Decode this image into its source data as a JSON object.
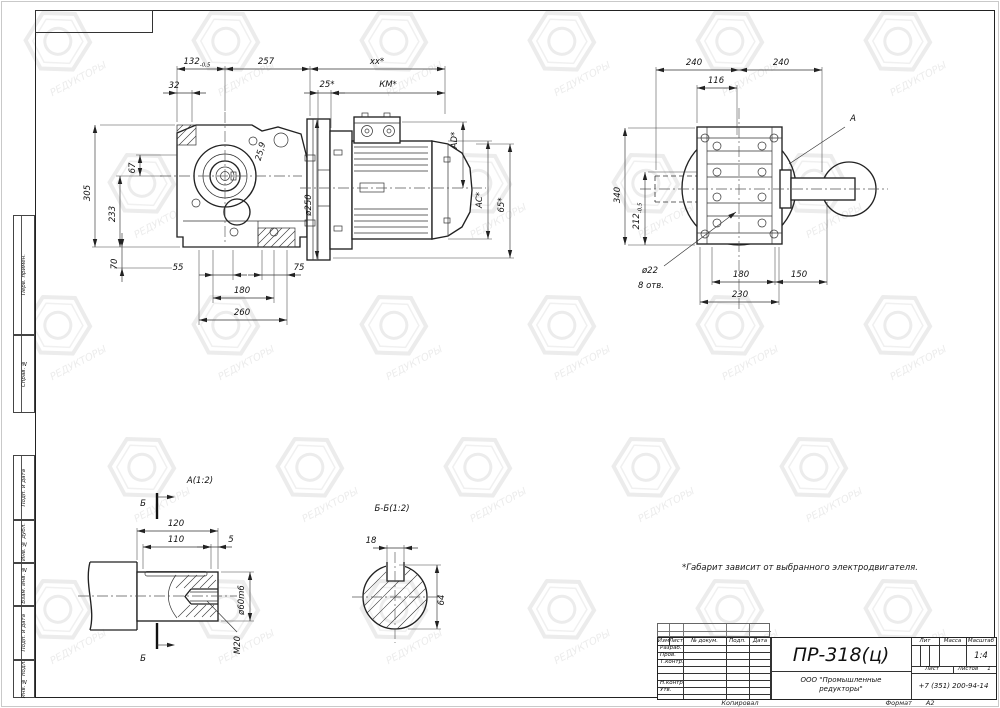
{
  "watermark": {
    "text": "РЕДУКТОРЫ"
  },
  "note": "*Габарит зависит от выбранного электродвигателя.",
  "margin_labels": [
    "Перв. примен.",
    "Справ. №",
    "Подп. и дата",
    "Инв. № дубл.",
    "Взам. инв. №",
    "Подп. и дата",
    "Инв. № подл."
  ],
  "title_block": {
    "doc_number": "ПР-318(ц)",
    "col_headers": [
      "Изм",
      "Лист",
      "№ докум.",
      "Подп.",
      "Дата"
    ],
    "row_labels": [
      "Разраб.",
      "Пров.",
      "Т.контр.",
      "Н.контр.",
      "Утв."
    ],
    "lit_label": "Лит",
    "mass_label": "Масса",
    "scale_label": "Масштаб",
    "scale_value": "1:4",
    "sheet_label": "Лист",
    "sheets_label": "Листов",
    "sheets_value": "1",
    "company_line1": "ООО \"Промышленные",
    "company_line2": "редукторы\"",
    "phone": "+7 (351) 200-94-14",
    "copied_label": "Копировал",
    "format_label": "Формат",
    "format_value": "А2"
  },
  "drawing": {
    "front": [
      {
        "t": "h",
        "x1": 177,
        "x2": 225,
        "y": 69,
        "tx": 197,
        "ty": 64,
        "s": "132",
        "sub": "-0,5",
        "ext": [
          [
            177,
            122,
            177,
            66
          ],
          [
            225,
            111,
            225,
            66
          ]
        ]
      },
      {
        "t": "h",
        "x1": 225,
        "x2": 310,
        "y": 69,
        "tx": 266,
        "ty": 64,
        "s": "257",
        "ext": [
          [
            310,
            116,
            310,
            66
          ]
        ]
      },
      {
        "t": "h",
        "x1": 310,
        "x2": 445,
        "y": 69,
        "tx": 377,
        "ty": 64,
        "s": "xx*",
        "ext": [
          [
            445,
            114,
            445,
            66
          ]
        ]
      },
      {
        "t": "h",
        "x1": 177,
        "x2": 192,
        "y": 93,
        "tx": 174,
        "ty": 88,
        "s": "32",
        "out": 1,
        "ext": [
          [
            192,
            122,
            192,
            90
          ]
        ]
      },
      {
        "t": "h",
        "x1": 318,
        "x2": 331,
        "y": 93,
        "tx": 327,
        "ty": 87,
        "s": "25*",
        "out": 1,
        "ext": [
          [
            318,
            128,
            318,
            90
          ],
          [
            331,
            128,
            331,
            90
          ]
        ]
      },
      {
        "t": "h",
        "x1": 331,
        "x2": 445,
        "y": 93,
        "tx": 388,
        "ty": 87,
        "s": "КМ*"
      },
      {
        "t": "h",
        "x1": 213,
        "x2": 233,
        "y": 275,
        "tx": 178,
        "ty": 270,
        "s": "55",
        "out": 1,
        "ext": [
          [
            213,
            250,
            213,
            303
          ],
          [
            233,
            250,
            233,
            280
          ]
        ]
      },
      {
        "t": "h",
        "x1": 262,
        "x2": 287,
        "y": 275,
        "tx": 299,
        "ty": 270,
        "s": "75",
        "out": 1,
        "ext": [
          [
            262,
            250,
            262,
            280
          ],
          [
            287,
            250,
            287,
            325
          ]
        ]
      },
      {
        "t": "h",
        "x1": 213,
        "x2": 274,
        "y": 298,
        "tx": 242,
        "ty": 293,
        "s": "180",
        "ext": [
          [
            274,
            250,
            274,
            303
          ]
        ]
      },
      {
        "t": "h",
        "x1": 199,
        "x2": 287,
        "y": 320,
        "tx": 242,
        "ty": 315,
        "s": "260",
        "ext": [
          [
            199,
            250,
            199,
            325
          ]
        ]
      },
      {
        "t": "v",
        "x": 95,
        "y1": 125,
        "y2": 247,
        "tx": 90,
        "ty": 193,
        "s": "305",
        "ext": [
          [
            100,
            125,
            175,
            125
          ],
          [
            92,
            247,
            180,
            247
          ]
        ]
      },
      {
        "t": "v",
        "x": 120,
        "y1": 176,
        "y2": 247,
        "tx": 115,
        "ty": 214,
        "s": "233",
        "ext": [
          [
            116,
            176,
            162,
            176
          ]
        ]
      },
      {
        "t": "v",
        "x": 140,
        "y1": 155,
        "y2": 176,
        "tx": 135,
        "ty": 168,
        "s": "67",
        "ext": [
          [
            136,
            155,
            177,
            155
          ]
        ]
      },
      {
        "t": "v",
        "x": 122,
        "y1": 247,
        "y2": 268,
        "tx": 117,
        "ty": 264,
        "s": "70",
        "out": 1,
        "ext": [
          [
            114,
            268,
            172,
            268
          ]
        ]
      },
      {
        "t": "v",
        "x": 463,
        "y1": 122,
        "y2": 188,
        "tx": 457,
        "ty": 140,
        "s": "AD*",
        "ext": [
          [
            402,
            122,
            467,
            122
          ]
        ]
      },
      {
        "t": "v",
        "x": 488,
        "y1": 141,
        "y2": 239,
        "tx": 482,
        "ty": 200,
        "s": "AC*",
        "ext": [
          [
            448,
            141,
            492,
            141
          ],
          [
            448,
            239,
            492,
            239
          ]
        ]
      },
      {
        "t": "v",
        "x": 510,
        "y1": 144,
        "y2": 258,
        "tx": 504,
        "ty": 205,
        "s": "65*",
        "ext": [
          [
            476,
            144,
            514,
            144
          ],
          [
            333,
            258,
            514,
            258
          ]
        ]
      },
      {
        "t": "v",
        "x": 317,
        "y1": 120,
        "y2": 259,
        "tx": 311,
        "ty": 205,
        "s": "ø250"
      },
      {
        "t": "t",
        "tx": 263,
        "ty": 152,
        "s": "25,9",
        "rot": -75
      }
    ],
    "side": [
      {
        "t": "h",
        "x1": 656,
        "x2": 739,
        "y": 70,
        "tx": 694,
        "ty": 65,
        "s": "240",
        "ext": [
          [
            656,
            170,
            656,
            67
          ]
        ]
      },
      {
        "t": "h",
        "x1": 739,
        "x2": 822,
        "y": 70,
        "tx": 781,
        "ty": 65,
        "s": "240",
        "ext": [
          [
            822,
            172,
            822,
            67
          ]
        ]
      },
      {
        "t": "h",
        "x1": 697,
        "x2": 737,
        "y": 88,
        "tx": 716,
        "ty": 83,
        "s": "116",
        "ext": [
          [
            697,
            123,
            697,
            85
          ],
          [
            737,
            135,
            737,
            85
          ]
        ]
      },
      {
        "t": "h",
        "x1": 712,
        "x2": 775,
        "y": 282,
        "tx": 741,
        "ty": 277,
        "s": "180",
        "ext": [
          [
            712,
            247,
            712,
            285
          ],
          [
            775,
            247,
            775,
            285
          ]
        ]
      },
      {
        "t": "h",
        "x1": 775,
        "x2": 827,
        "y": 282,
        "tx": 799,
        "ty": 277,
        "s": "150",
        "ext": [
          [
            827,
            202,
            827,
            285
          ]
        ]
      },
      {
        "t": "h",
        "x1": 700,
        "x2": 779,
        "y": 302,
        "tx": 740,
        "ty": 297,
        "s": "230",
        "ext": [
          [
            700,
            247,
            700,
            305
          ],
          [
            779,
            247,
            779,
            305
          ]
        ]
      },
      {
        "t": "v",
        "x": 625,
        "y1": 128,
        "y2": 245,
        "tx": 620,
        "ty": 195,
        "s": "340",
        "ext": [
          [
            628,
            128,
            695,
            128
          ],
          [
            628,
            245,
            695,
            245
          ]
        ]
      },
      {
        "t": "v",
        "x": 645,
        "y1": 172,
        "y2": 245,
        "tx": 639,
        "ty": 216,
        "s": "212",
        "sub": "-0,5",
        "ext": [
          [
            648,
            172,
            697,
            172
          ]
        ]
      },
      {
        "t": "t",
        "tx": 650,
        "ty": 273,
        "s": "ø22"
      },
      {
        "t": "t",
        "tx": 651,
        "ty": 288,
        "s": "8 отв."
      },
      {
        "t": "l",
        "x1": 664,
        "y1": 266,
        "x2": 736,
        "y2": 212
      },
      {
        "t": "t",
        "tx": 853,
        "ty": 121,
        "s": "A",
        "fs": 13
      },
      {
        "t": "l",
        "x1": 845,
        "y1": 127,
        "x2": 789,
        "y2": 164,
        "noarrow": 1
      }
    ],
    "da": [
      {
        "t": "t",
        "tx": 200,
        "ty": 483,
        "s": "А(1:2)",
        "fs": 12
      },
      {
        "t": "t",
        "tx": 143,
        "ty": 506,
        "s": "Б",
        "fs": 12
      },
      {
        "t": "t",
        "tx": 143,
        "ty": 661,
        "s": "Б",
        "fs": 12
      },
      {
        "t": "h",
        "x1": 137,
        "x2": 218,
        "y": 531,
        "tx": 176,
        "ty": 526,
        "s": "120",
        "ext": [
          [
            137,
            560,
            137,
            528
          ],
          [
            218,
            569,
            218,
            528
          ]
        ]
      },
      {
        "t": "h",
        "x1": 143,
        "x2": 211,
        "y": 547,
        "tx": 176,
        "ty": 542,
        "s": "110",
        "ext": [
          [
            143,
            569,
            143,
            544
          ],
          [
            211,
            569,
            211,
            544
          ]
        ]
      },
      {
        "t": "h",
        "x1": 211,
        "x2": 218,
        "y": 547,
        "tx": 231,
        "ty": 542,
        "s": "5",
        "out": 1
      },
      {
        "t": "v",
        "x": 250,
        "y1": 572,
        "y2": 621,
        "tx": 244,
        "ty": 600,
        "s": "ø60m6",
        "ext": [
          [
            221,
            572,
            254,
            572
          ],
          [
            221,
            621,
            254,
            621
          ]
        ]
      },
      {
        "t": "t",
        "tx": 240,
        "ty": 645,
        "s": "М20",
        "rot": -90
      },
      {
        "t": "l",
        "x1": 237,
        "y1": 632,
        "x2": 207,
        "y2": 601,
        "noarrow": 1
      }
    ],
    "sb": [
      {
        "t": "t",
        "tx": 392,
        "ty": 511,
        "s": "Б-Б(1:2)",
        "fs": 12
      },
      {
        "t": "h",
        "x1": 387,
        "x2": 404,
        "y": 548,
        "tx": 371,
        "ty": 543,
        "s": "18",
        "out": 1,
        "ext": [
          [
            387,
            562,
            387,
            545
          ],
          [
            404,
            562,
            404,
            545
          ]
        ]
      },
      {
        "t": "v",
        "x": 437,
        "y1": 565,
        "y2": 629,
        "tx": 444,
        "ty": 600,
        "s": "64",
        "rot": -90,
        "ext": [
          [
            399,
            565,
            441,
            565
          ],
          [
            408,
            629,
            441,
            629
          ]
        ]
      }
    ]
  }
}
